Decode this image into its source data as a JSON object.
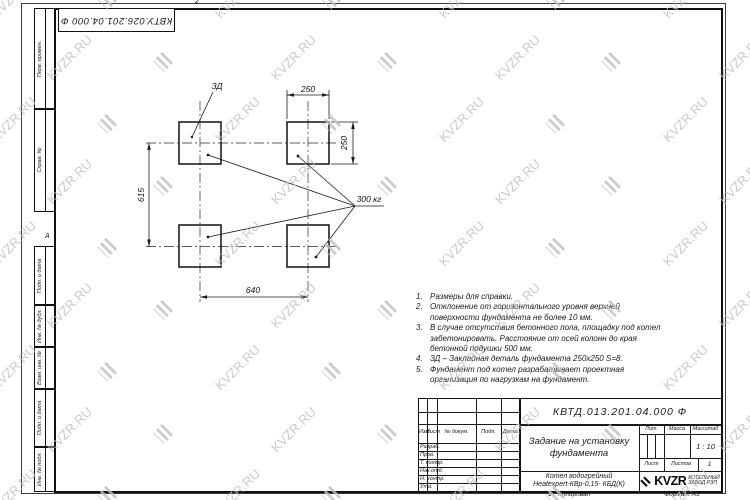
{
  "sheet": {
    "top_stamp": "КВТУ.026.201.04.000 Ф",
    "zone_top": "2",
    "zone_left": "А",
    "zone_bottom": "1",
    "copied_label": "Копировал",
    "format_label": "Формат А3"
  },
  "margin_labels": [
    "Перв. примен.",
    "Справ. №",
    "Подп. и дата",
    "Инв. № дубл.",
    "Взам. инв. №",
    "Подп. и дата",
    "Инв. № подл."
  ],
  "drawing": {
    "dim_top": "250",
    "dim_right": "250",
    "dim_left": "615",
    "dim_bottom": "640",
    "embed_label": "ЗД",
    "load_label": "300 кг"
  },
  "notes": [
    {
      "num": "1.",
      "text": "Размеры для справки."
    },
    {
      "num": "2.",
      "text": "Отклонение от горизонтального уровня верхней поверхности фундамента не более 10 мм."
    },
    {
      "num": "3.",
      "text": "В случае отсутствия бетонного пола, площадку под котел забетонировать. Расстояние от осей колонн до края бетонной подушки 500 мм."
    },
    {
      "num": "4.",
      "text": "ЗД – Закладная деталь фундамента 250х250 S=8."
    },
    {
      "num": "5.",
      "text": "Фундамент под котел разрабатывает проектная организация по нагрузкам на фундамент."
    }
  ],
  "title_block": {
    "designation": "КВТД.013.201.04.000 Ф",
    "title_line1": "Задание на установку",
    "title_line2": "фундамента",
    "product_line1": "Котел водогрейный",
    "product_line2": "Heatexpert-КВр-0,15- КБД(К)",
    "col_izm": "Изм",
    "col_list": "Лист",
    "col_doc": "№ докум.",
    "col_podp": "Подп.",
    "col_data": "Дата",
    "sig_rows": [
      "Разраб.",
      "Пров.",
      "Т. контр.",
      "Нач.отд.",
      "Н. контр.",
      "Утв."
    ],
    "lit_label": "Лит.",
    "mass_label": "Масса",
    "scale_label": "Масштаб",
    "scale_value": "1 : 10",
    "sheet_label": "Лист",
    "sheets_label": "Листов",
    "sheets_value": "1",
    "logo_text": "KVZR",
    "logo_sub1": "КОТЕЛЬНЫЙ",
    "logo_sub2": "ЗАВОД РЭП"
  },
  "watermark": {
    "text": "KVZR.RU"
  }
}
